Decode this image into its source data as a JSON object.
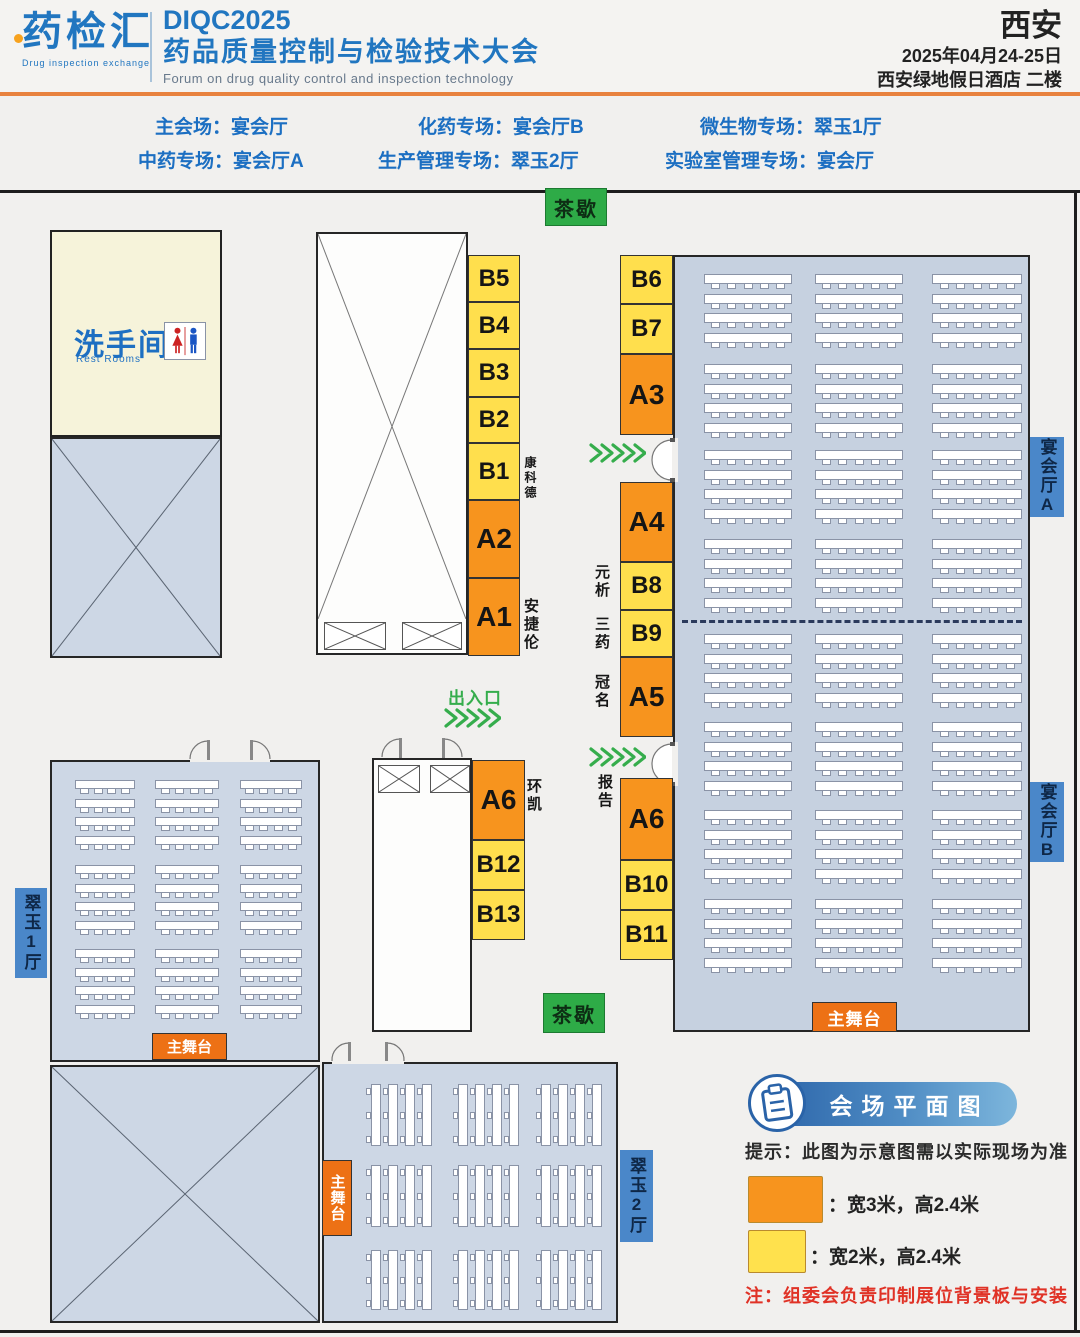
{
  "header": {
    "logo_text": "药检汇",
    "logo_subtitle": "Drug inspection exchange",
    "title_code": "DIQC2025",
    "title_cn": "药品质量控制与检验技术大会",
    "title_en": "Forum on drug quality control and inspection technology",
    "city": "西安",
    "date": "2025年04月24-25日",
    "venue": "西安绿地假日酒店 二楼"
  },
  "sessions": [
    "主会场：宴会厅",
    "化药专场：宴会厅B",
    "微生物专场：翠玉1厅",
    "中药专场：宴会厅A",
    "生产管理专场：翠玉2厅",
    "实验室管理专场：宴会厅"
  ],
  "map": {
    "tea_break_top": "茶歇",
    "tea_break_bottom": "茶歇",
    "restroom_title": "洗手间",
    "restroom_subtitle": "Rest Rooms",
    "entrance_label": "出入口",
    "stage_label_main": "主舞台",
    "stage_label_cuiyu1": "主舞台",
    "stage_label_cuiyu2": "主舞台",
    "hall_labels": {
      "yanhui_a": "宴会厅A",
      "yanhui_b": "宴会厅B",
      "cuiyu_1": "翠玉1厅",
      "cuiyu_2": "翠玉2厅"
    },
    "booths": [
      {
        "id": "b5",
        "label": "B5",
        "type": "yellow"
      },
      {
        "id": "b4",
        "label": "B4",
        "type": "yellow"
      },
      {
        "id": "b3",
        "label": "B3",
        "type": "yellow"
      },
      {
        "id": "b2",
        "label": "B2",
        "type": "yellow"
      },
      {
        "id": "b1",
        "label": "B1",
        "type": "yellow"
      },
      {
        "id": "a2",
        "label": "A2",
        "type": "orange"
      },
      {
        "id": "a1",
        "label": "A1",
        "type": "orange"
      },
      {
        "id": "b6",
        "label": "B6",
        "type": "yellow"
      },
      {
        "id": "b7",
        "label": "B7",
        "type": "yellow"
      },
      {
        "id": "a3",
        "label": "A3",
        "type": "orange"
      },
      {
        "id": "a4",
        "label": "A4",
        "type": "orange"
      },
      {
        "id": "b8",
        "label": "B8",
        "type": "yellow"
      },
      {
        "id": "b9",
        "label": "B9",
        "type": "yellow"
      },
      {
        "id": "a5",
        "label": "A5",
        "type": "orange"
      },
      {
        "id": "a6r",
        "label": "A6",
        "type": "orange"
      },
      {
        "id": "b10",
        "label": "B10",
        "type": "yellow"
      },
      {
        "id": "b11",
        "label": "B11",
        "type": "yellow"
      },
      {
        "id": "a6l",
        "label": "A6",
        "type": "orange"
      },
      {
        "id": "b12",
        "label": "B12",
        "type": "yellow"
      },
      {
        "id": "b13",
        "label": "B13",
        "type": "yellow"
      }
    ],
    "sponsor_labels": [
      {
        "id": "kangkede",
        "text": "康科德"
      },
      {
        "id": "anjielun",
        "text": "安捷伦"
      },
      {
        "id": "huankai",
        "text": "环凯"
      },
      {
        "id": "yuanxi",
        "text": "元析"
      },
      {
        "id": "sanyao",
        "text": "三药"
      },
      {
        "id": "guanming",
        "text": "冠名"
      },
      {
        "id": "baogao",
        "text": "报告"
      }
    ]
  },
  "legend": {
    "title": "会场平面图",
    "tip": "提示：此图为示意图需以实际现场为准",
    "orange_label": "：宽3米，高2.4米",
    "yellow_label": "：宽2米，高2.4米",
    "note": "注：组委会负责印制展位背景板与安装"
  },
  "colors": {
    "booth_orange": "#F7941E",
    "booth_yellow": "#FFDF4D",
    "tea_green": "#2EAB47",
    "hall_label_blue": "#4A87C9",
    "header_blue": "#2176C0",
    "note_red": "#E03226",
    "room_fill": "#CDD7E5",
    "stage_orange": "#ED7115"
  }
}
